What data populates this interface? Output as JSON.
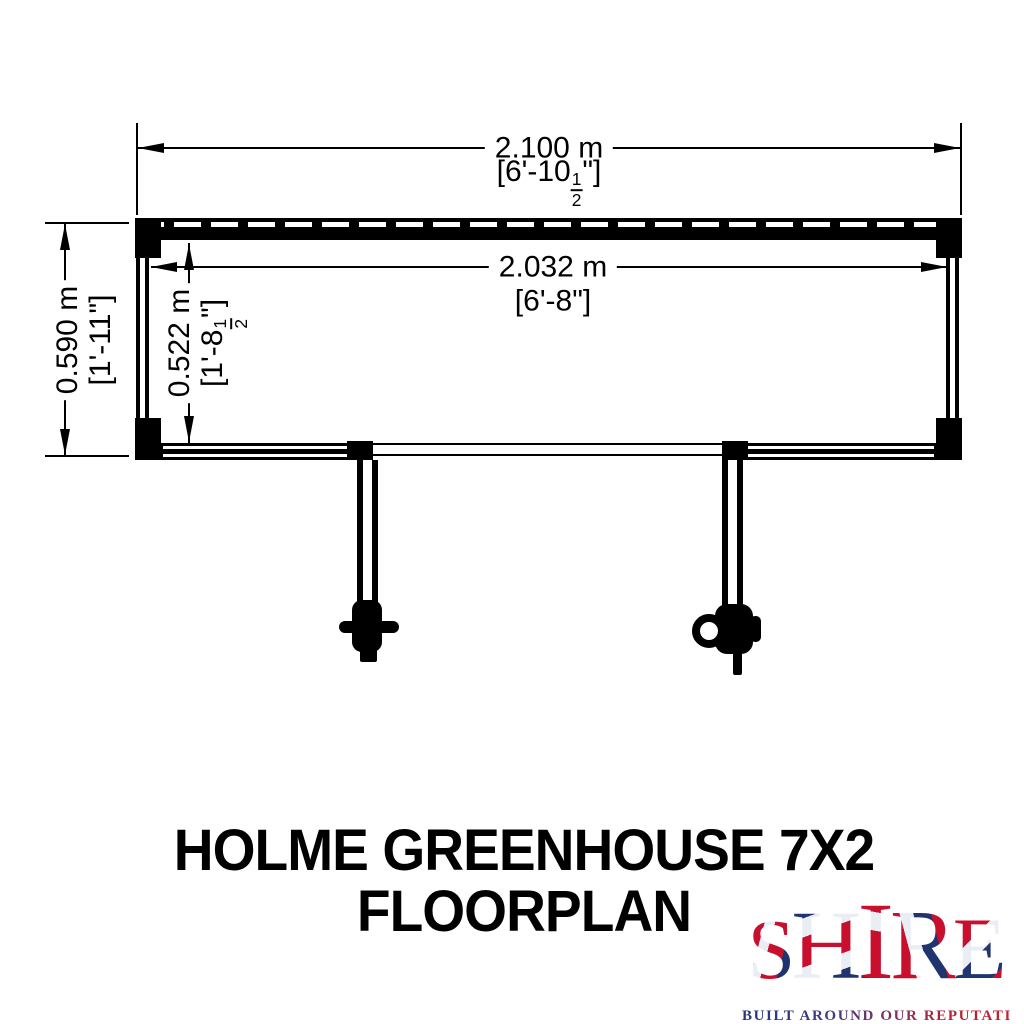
{
  "colors": {
    "ink": "#000000",
    "flag_red": "#c8102e",
    "flag_blue": "#20356f",
    "flag_white": "#e9edf4"
  },
  "dimensions": {
    "top_outer": {
      "metric": "2.100 m",
      "imperial_prefix": "[6'-10",
      "fraction_numerator": "1",
      "fraction_denominator": "2",
      "imperial_suffix": "\"]"
    },
    "top_inner": {
      "metric": "2.032 m",
      "imperial": "[6'-8\"]"
    },
    "left_outer": {
      "metric": "0.590 m",
      "imperial": "[1'-11\"]"
    },
    "left_inner": {
      "metric": "0.522 m",
      "imperial_prefix": "[1'-8",
      "fraction_numerator": "1",
      "fraction_denominator": "2",
      "imperial_suffix": "\"]"
    }
  },
  "title": {
    "line1": "HOLME GREENHOUSE 7X2",
    "line2": "FLOORPLAN"
  },
  "logo": {
    "letters": [
      "S",
      "H",
      "I",
      "R",
      "E"
    ],
    "tagline": "BUILT AROUND OUR REPUTATION"
  }
}
